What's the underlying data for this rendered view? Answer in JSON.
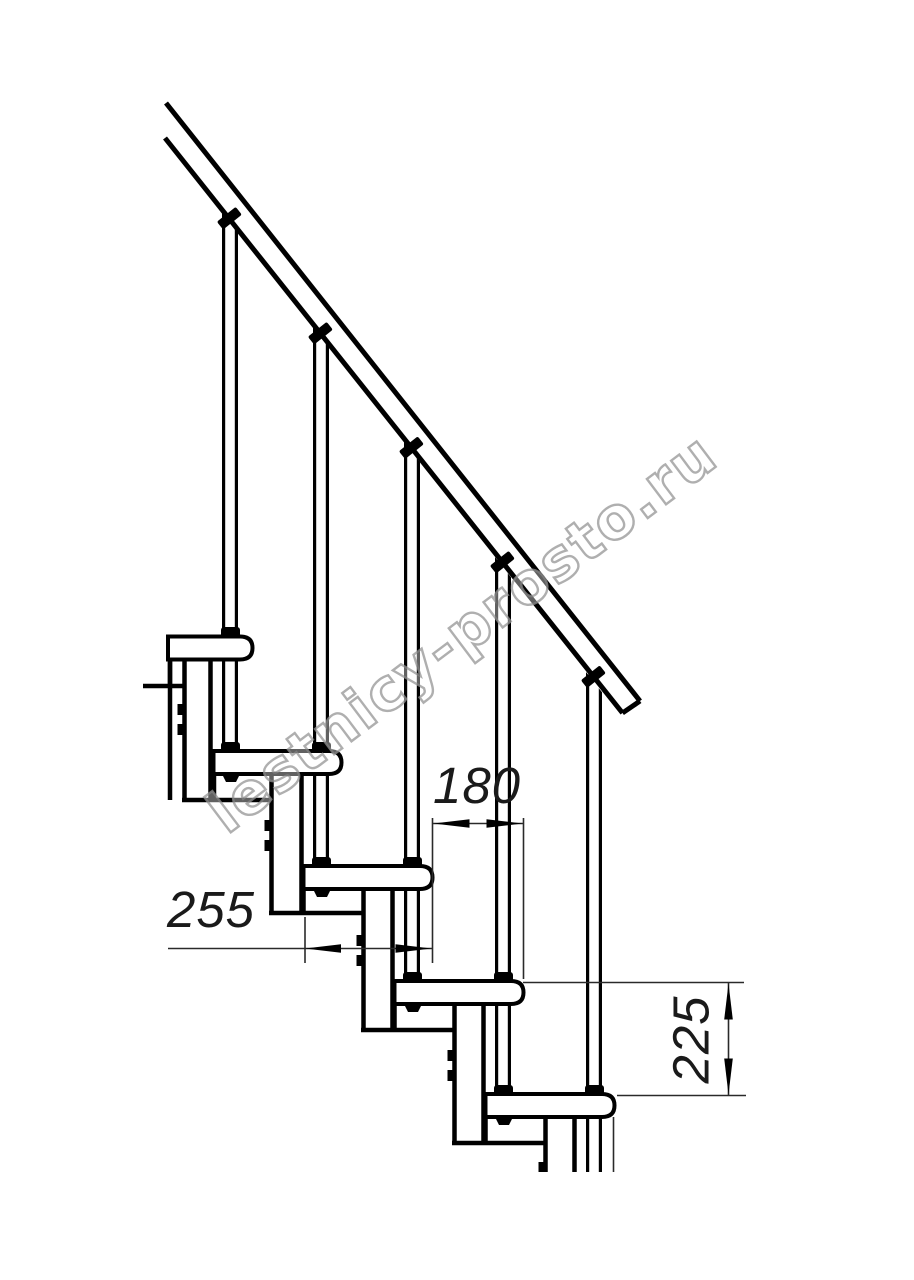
{
  "drawing": {
    "kind": "staircase side elevation, modular stair technical drawing",
    "units_implied": "mm",
    "dimensions": {
      "tread_depth": {
        "label": "255",
        "meaning": "tread depth"
      },
      "step_run": {
        "label": "180",
        "meaning": "horizontal run between step noses"
      },
      "step_rise": {
        "label": "225",
        "meaning": "vertical rise between steps"
      }
    },
    "colors": {
      "line": "#000000",
      "background": "#ffffff",
      "watermark_outline": "#949494"
    }
  },
  "watermark": {
    "text": "lestnicy-prosto.ru"
  }
}
